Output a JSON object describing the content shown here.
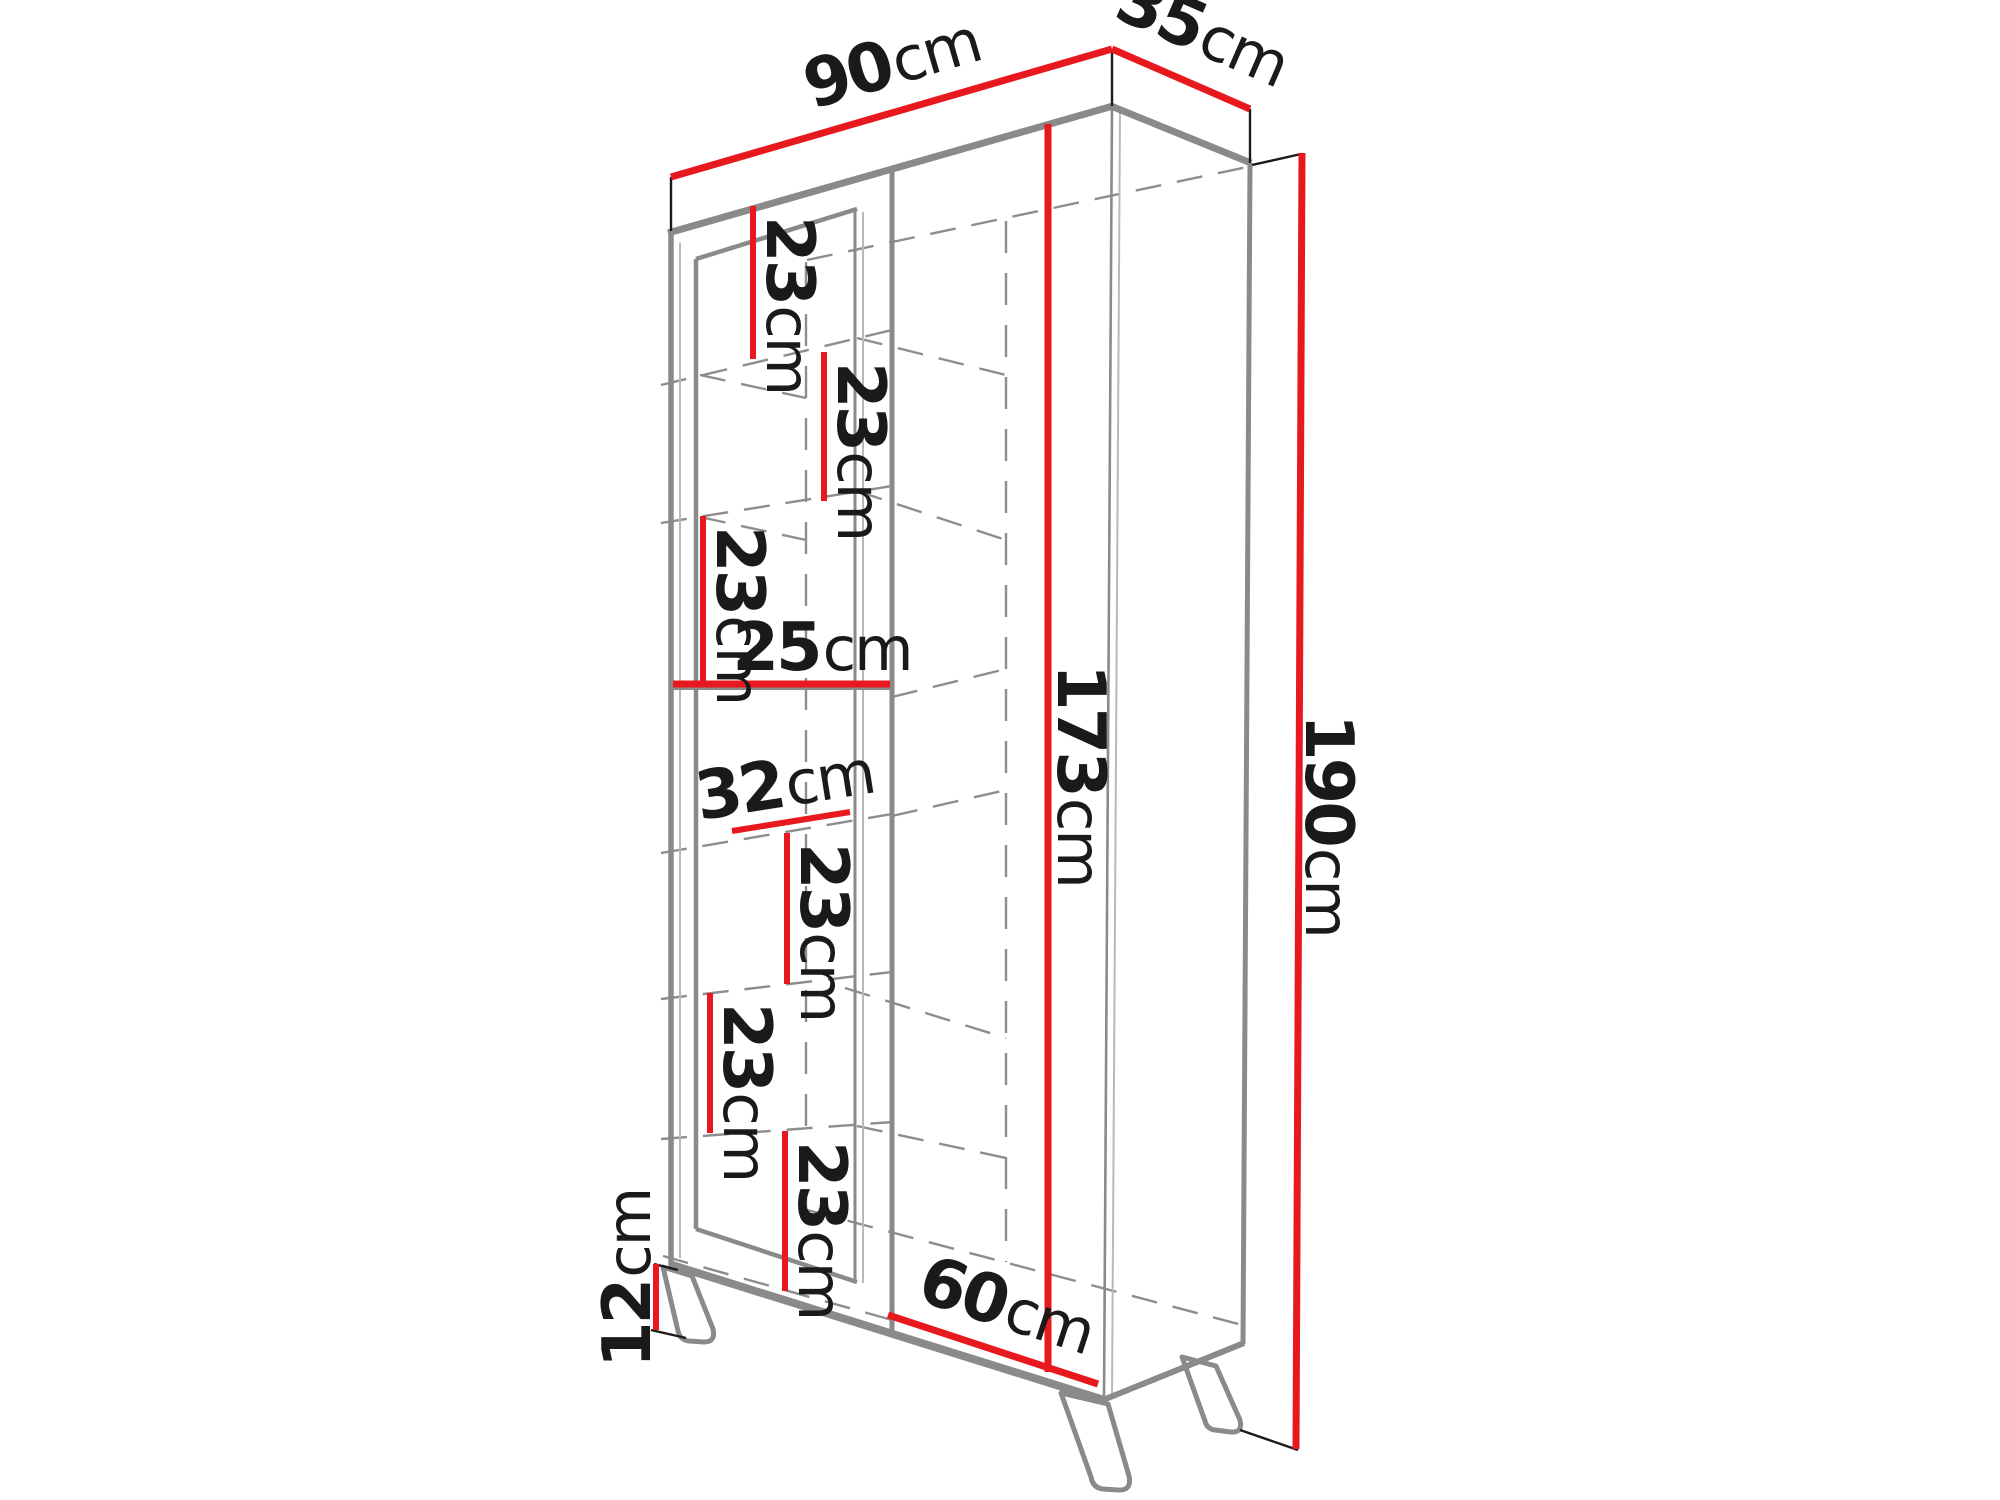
{
  "diagram": {
    "dimensions": {
      "width": {
        "value": "90",
        "unit": "cm"
      },
      "depth": {
        "value": "35",
        "unit": "cm"
      },
      "height": {
        "value": "190",
        "unit": "cm"
      },
      "interior_height": {
        "value": "173",
        "unit": "cm"
      },
      "leg_height": {
        "value": "12",
        "unit": "cm"
      },
      "left_section_width": {
        "value": "25",
        "unit": "cm"
      },
      "shelf_depth": {
        "value": "32",
        "unit": "cm"
      },
      "bottom_section_width": {
        "value": "60",
        "unit": "cm"
      },
      "shelf_gaps": [
        {
          "value": "23",
          "unit": "cm"
        },
        {
          "value": "23",
          "unit": "cm"
        },
        {
          "value": "23",
          "unit": "cm"
        },
        {
          "value": "23",
          "unit": "cm"
        },
        {
          "value": "23",
          "unit": "cm"
        },
        {
          "value": "23",
          "unit": "cm"
        }
      ]
    },
    "colors": {
      "dimension_line": "#e8191e",
      "structure": "#8a8a8a",
      "text": "#1a1a1a",
      "background": "#ffffff"
    }
  }
}
